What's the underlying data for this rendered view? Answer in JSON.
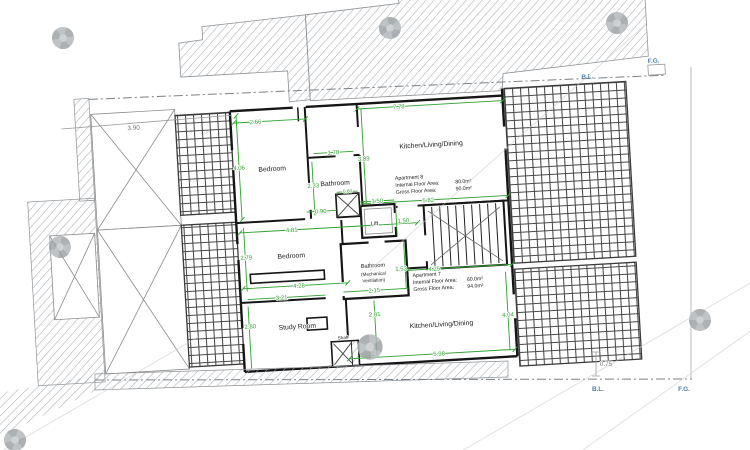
{
  "rooms": {
    "bedroom1": "Bedroom",
    "bathroom1": "Bathroom",
    "kitchen1": "Kitchen/Living/Dining",
    "lift": "Lift",
    "bathroom2": "Bathroom",
    "bathroom2_sub1": "(Mechanical",
    "bathroom2_sub2": "Ventilation)",
    "bedroom2": "Bedroom",
    "study": "Study Room",
    "kitchen2": "Kitchen/Living/Dining",
    "shaft": "Shaft"
  },
  "apartments": {
    "apt8": {
      "name": "Apartment 8",
      "internal_label": "Internal Floor Area:",
      "internal_value": "80.0m²",
      "gross_label": "Gross Floor Area:",
      "gross_value": "90.0m²"
    },
    "apt7": {
      "name": "Apartment 7",
      "internal_label": "Internal Floor Area:",
      "internal_value": "60.0m²",
      "gross_label": "Gross Floor Area:",
      "gross_value": "94.0m²"
    }
  },
  "dims": {
    "bedroom1_w": "2.66",
    "kitchen1_w_top": "7.78",
    "bedroom1_h": "4.06",
    "bathroom1_w": "1.78",
    "bathroom1_h": "2.33",
    "kitchen1_h": "3.89",
    "entry_w": "0.90",
    "hall_w": "4.81",
    "lift_w": "1.50",
    "lift_h": "1.50",
    "kitchen1_w": "5.82",
    "shaft1_w": "0.60",
    "bedroom2_h": "2.79",
    "bedroom2_w": "4.28",
    "study_w": "3.21",
    "study_h": "2.80",
    "bath2_w": "2.15",
    "bath2_h": "1.53",
    "hall2_w": "4.25",
    "kitchen2_h_left": "2.81",
    "kitchen2_h_right": "4.04",
    "kitchen2_w": "5.98",
    "shaft2_w": "0.60",
    "site_left": "3.90",
    "site_right": "0.75",
    "faint1": "1.06",
    "faint2": "2.52"
  },
  "boundary": {
    "bl_top": "B.L.",
    "fg_top": "F.G.",
    "bl_bottom": "B.L.",
    "fg_bottom": "F.G."
  },
  "colors": {
    "dimension_green": "#2fa12f",
    "boundary_blue": "#4a7caa",
    "wall_black": "#161616",
    "hatch_gray": "#a8adb2",
    "watermark_gray": "#b5b9bc"
  }
}
